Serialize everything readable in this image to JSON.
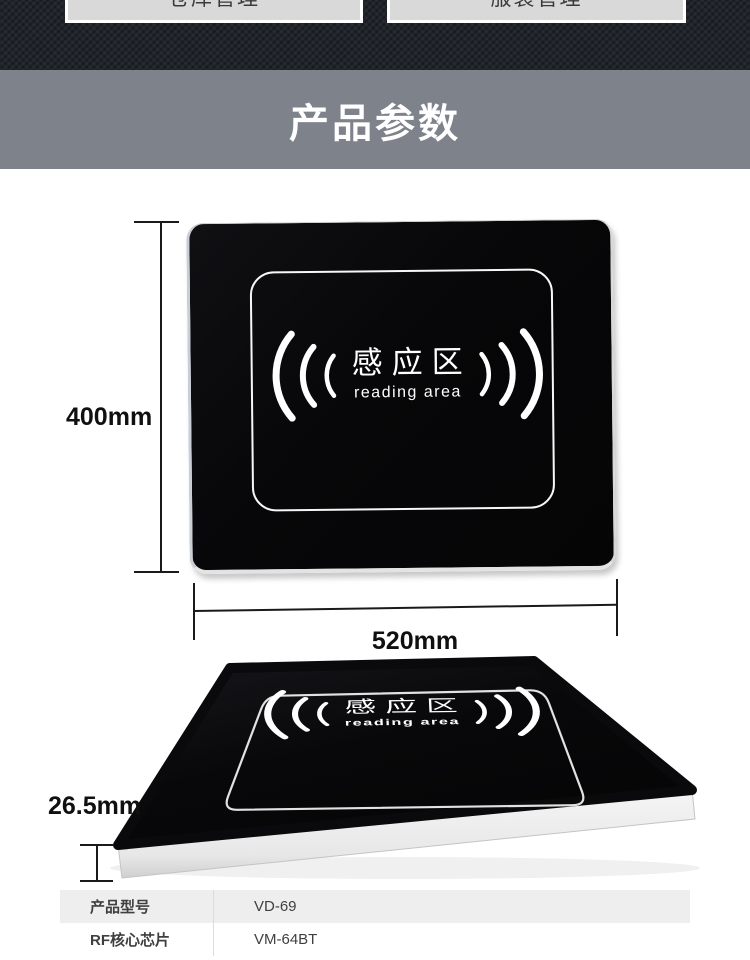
{
  "topbar": {
    "buttons": [
      {
        "label": "仓库管理"
      },
      {
        "label": "服装管理"
      }
    ]
  },
  "banner": {
    "title": "产品参数"
  },
  "product": {
    "emblem_cn": "感应区",
    "emblem_en": "reading area"
  },
  "front_view": {
    "height_label": "400mm",
    "width_label": "520mm"
  },
  "side_view": {
    "thickness_label": "26.5mm"
  },
  "spec_table": {
    "rows": [
      {
        "label": "产品型号",
        "value": "VD-69"
      },
      {
        "label": "RF核心芯片",
        "value": "VM-64BT"
      }
    ]
  },
  "colors": {
    "topbar_bg": "#20242b",
    "button_bg": "#d9d9d9",
    "banner_bg": "#7d828b",
    "panel_black": "#070709",
    "panel_rim": "#dfe2e8",
    "table_alt_row": "#eeeeee"
  }
}
